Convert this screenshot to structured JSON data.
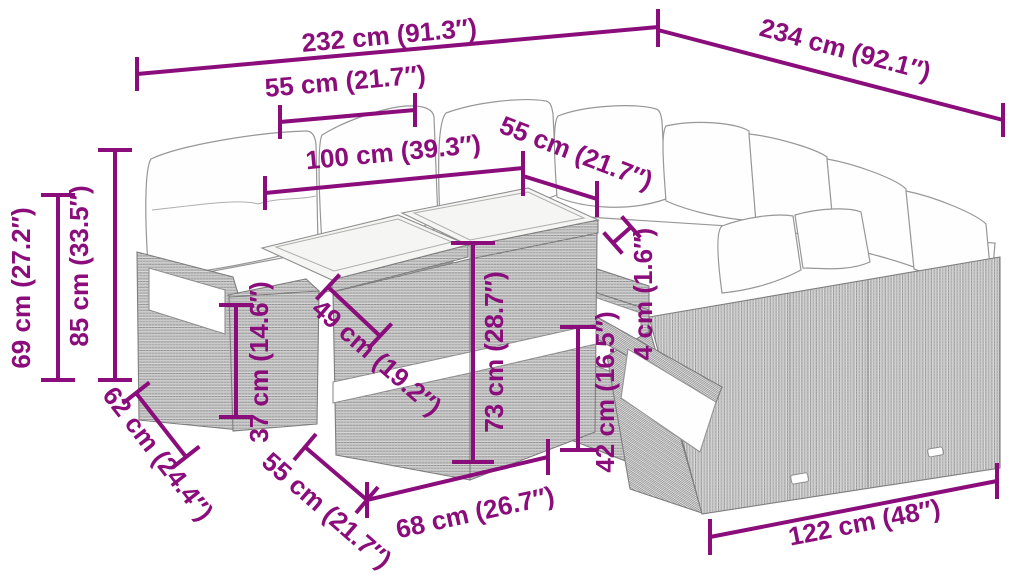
{
  "diagram": {
    "kind": "product-dimension-diagram",
    "subject": "rattan garden corner sofa set with glass-top table, drawn as gray line art",
    "colors": {
      "dim-color": "#8a0d7b",
      "line-color": "#7e7e7e"
    }
  },
  "dimensions": [
    {
      "name": "overall-width-left",
      "label": "232 cm (91.3″)"
    },
    {
      "name": "overall-width-right",
      "label": "234 cm (92.1″)"
    },
    {
      "name": "seat-width",
      "label": "55 cm (21.7″)"
    },
    {
      "name": "table-length",
      "label": "100 cm (39.3″)"
    },
    {
      "name": "corner-seat-depth",
      "label": "55 cm (21.7″)"
    },
    {
      "name": "armrest-height",
      "label": "69 cm (27.2″)"
    },
    {
      "name": "back-height",
      "label": "85 cm (33.5″)"
    },
    {
      "name": "side-depth",
      "label": "62 cm (24.4″)"
    },
    {
      "name": "under-seat-height",
      "label": "37 cm (14.6″)"
    },
    {
      "name": "tabletop-depth",
      "label": "49 cm (19.2″)"
    },
    {
      "name": "table-height",
      "label": "73 cm (28.7″)"
    },
    {
      "name": "seat-height",
      "label": "42 cm (16.5″)"
    },
    {
      "name": "cushion-thickness",
      "label": "4 cm (1.6″)"
    },
    {
      "name": "stool-depth",
      "label": "55 cm (21.7″)"
    },
    {
      "name": "table-width",
      "label": "68 cm (26.7″)"
    },
    {
      "name": "right-module-width",
      "label": "122 cm (48″)"
    }
  ]
}
